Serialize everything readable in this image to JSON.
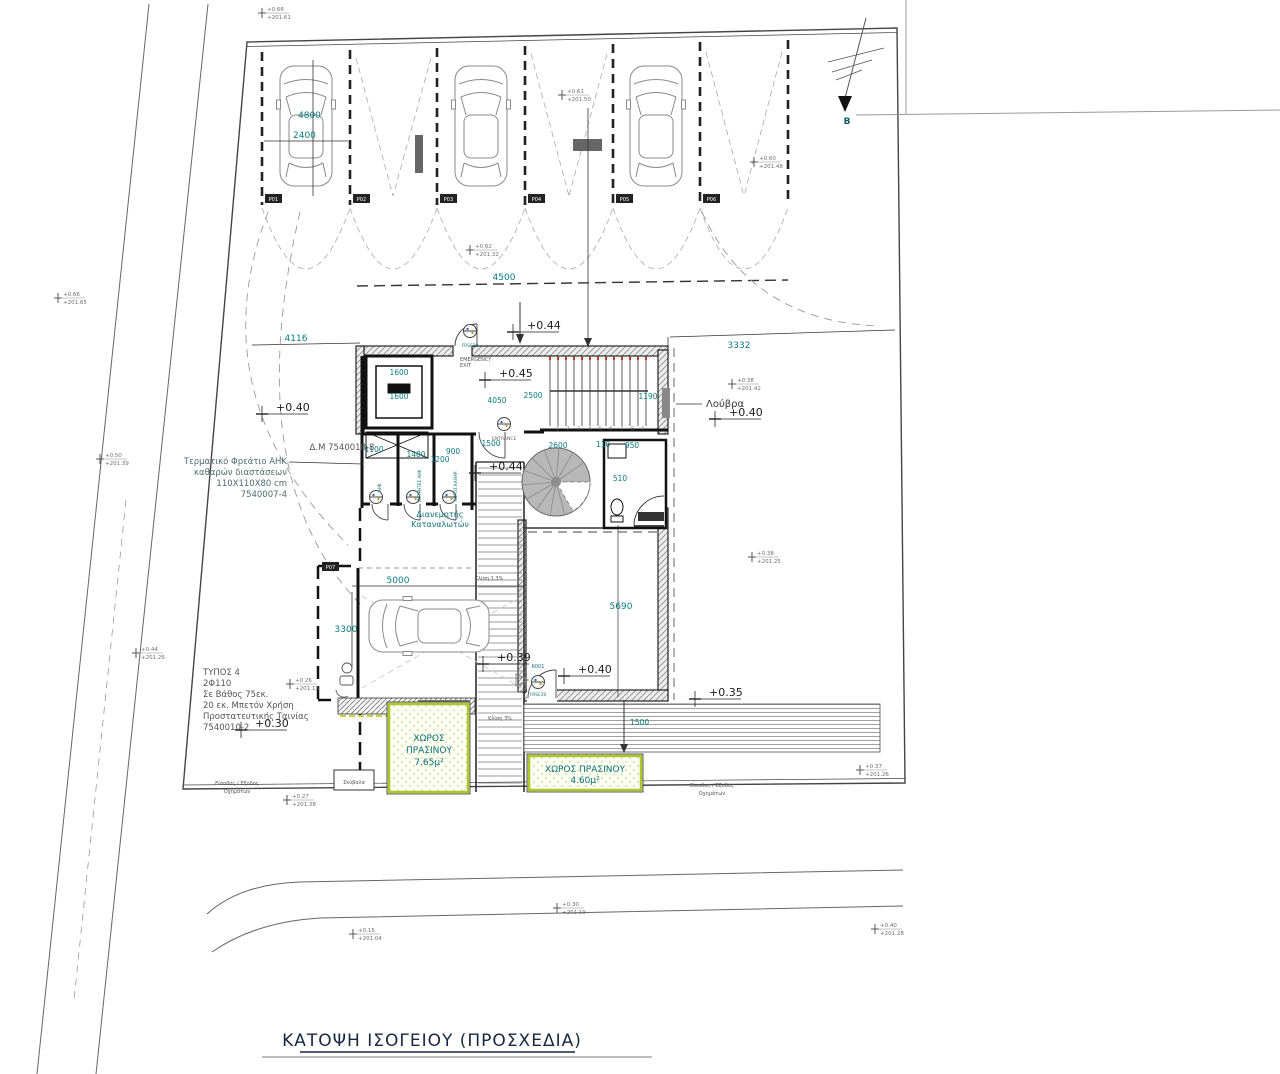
{
  "title": {
    "text": "ΚΑΤΟΨΗ ΙΣΟΓΕΙΟΥ (ΠΡΟΣΧΕΔΙΑ)"
  },
  "north_label": "Β",
  "colors": {
    "accent_teal": "#0b7a80",
    "wall_black": "#111111",
    "green_border": "#aec829",
    "stair_gray": "#b8b8b8",
    "line_gray": "#3c3c3c"
  },
  "parking_tags": [
    {
      "label": "P01",
      "x": 265,
      "y": 194
    },
    {
      "label": "P02",
      "x": 353,
      "y": 194
    },
    {
      "label": "P03",
      "x": 440,
      "y": 194
    },
    {
      "label": "P04",
      "x": 528,
      "y": 194
    },
    {
      "label": "P05",
      "x": 616,
      "y": 194
    },
    {
      "label": "P06",
      "x": 703,
      "y": 194
    },
    {
      "label": "P07",
      "x": 322,
      "y": 562
    }
  ],
  "annotations": [
    {
      "n": "dim-4800",
      "t": "4800",
      "x": 298,
      "y": 118,
      "c": "dim"
    },
    {
      "n": "dim-2400",
      "t": "2400",
      "x": 293,
      "y": 138,
      "c": "dim"
    },
    {
      "n": "dim-4500",
      "t": "4500",
      "x": 504,
      "y": 280,
      "c": "dim",
      "a": "middle"
    },
    {
      "n": "dim-4116",
      "t": "4116",
      "x": 296,
      "y": 341,
      "c": "dim",
      "a": "middle"
    },
    {
      "n": "dim-3332",
      "t": "3332",
      "x": 739,
      "y": 348,
      "c": "dim",
      "a": "middle"
    },
    {
      "n": "dim-1600-a",
      "t": "1600",
      "x": 399,
      "y": 375,
      "c": "dimsm",
      "a": "middle"
    },
    {
      "n": "dim-1600-b",
      "t": "1600",
      "x": 399,
      "y": 399,
      "c": "dimsm",
      "a": "middle"
    },
    {
      "n": "dim-4050",
      "t": "4050",
      "x": 497,
      "y": 403,
      "c": "dimsm",
      "a": "middle"
    },
    {
      "n": "dim-2500",
      "t": "2500",
      "x": 533,
      "y": 398,
      "c": "dimsm",
      "a": "middle"
    },
    {
      "n": "dim-1190",
      "t": "1190",
      "x": 648,
      "y": 399,
      "c": "dimsm",
      "a": "middle"
    },
    {
      "n": "dim-1100",
      "t": "1100",
      "x": 374,
      "y": 452,
      "c": "dimsm",
      "a": "middle"
    },
    {
      "n": "dim-1400",
      "t": "1400",
      "x": 416,
      "y": 457,
      "c": "dimsm",
      "a": "middle"
    },
    {
      "n": "dim-900",
      "t": "900",
      "x": 453,
      "y": 454,
      "c": "dimsm",
      "a": "middle"
    },
    {
      "n": "dim-1200",
      "t": "1200",
      "x": 440,
      "y": 462,
      "c": "dimsm",
      "a": "middle"
    },
    {
      "n": "dim-1500-entry",
      "t": "1500",
      "x": 491,
      "y": 446,
      "c": "dimsm",
      "a": "middle"
    },
    {
      "n": "dim-2600",
      "t": "2600",
      "x": 558,
      "y": 448,
      "c": "dimsm",
      "a": "middle"
    },
    {
      "n": "dim-110",
      "t": "110",
      "x": 603,
      "y": 447,
      "c": "dimsm",
      "a": "middle"
    },
    {
      "n": "dim-950",
      "t": "950",
      "x": 632,
      "y": 448,
      "c": "dimsm",
      "a": "middle"
    },
    {
      "n": "dim-510",
      "t": "510",
      "x": 620,
      "y": 481,
      "c": "dimsm",
      "a": "middle"
    },
    {
      "n": "dim-5000",
      "t": "5000",
      "x": 398,
      "y": 583,
      "c": "dim",
      "a": "middle"
    },
    {
      "n": "dim-3300",
      "t": "3300",
      "x": 346,
      "y": 632,
      "c": "dim",
      "a": "middle"
    },
    {
      "n": "dim-5690",
      "t": "5690",
      "x": 621,
      "y": 609,
      "c": "dim",
      "a": "middle"
    },
    {
      "n": "dim-1500-green",
      "t": "1500",
      "x": 630,
      "y": 725,
      "c": "dimsm",
      "a": "start"
    },
    {
      "n": "label-emergency-exit",
      "t": "EMERGENCY\nEXIT",
      "x": 460,
      "y": 361,
      "c": "micro",
      "lh": 6
    },
    {
      "n": "label-entrance",
      "t": "ENTRANCE",
      "x": 492,
      "y": 440,
      "c": "micro2"
    },
    {
      "n": "label-louvra",
      "t": "Λούβρα",
      "x": 706,
      "y": 407,
      "c": "lbl-dark",
      "a": "start"
    },
    {
      "n": "label-dm-note",
      "t": "Δ.Μ 7540018-8",
      "x": 342,
      "y": 450,
      "c": "note-gray",
      "a": "middle"
    },
    {
      "n": "note-ahk",
      "t": "Τερματικό Φρεάτιο ΑΗΚ\nκαθαρών διαστάσεων\n110Χ110Χ80 cm\n7540007-4",
      "x": 287,
      "y": 464,
      "c": "note",
      "a": "end",
      "lh": 11
    },
    {
      "n": "note-typos",
      "t": "ΤΥΠΟΣ 4\n2Φ110\nΣε Βάθος 75εκ.\n20 εκ. Μπετόν Χρήση\nΠροστατευτικής Ταινίας\n7540010-2",
      "x": 203,
      "y": 675,
      "c": "note-gray",
      "a": "start",
      "lh": 11
    },
    {
      "n": "label-dianemitis",
      "t": "Διανεμητής\nΚαταναλωτών",
      "x": 440,
      "y": 517,
      "c": "lbl-teal",
      "a": "middle",
      "lh": 10
    },
    {
      "n": "label-green-1",
      "t": "ΧΩΡΟΣ\nΠΡΑΣΙΝΟΥ\n7.65μ²",
      "x": 429,
      "y": 741,
      "c": "green-lbl",
      "a": "middle",
      "lh": 12
    },
    {
      "n": "label-green-2",
      "t": "ΧΩΡΟΣ ΠΡΑΣΙΝΟΥ\n4.60μ²",
      "x": 585,
      "y": 772,
      "c": "green-lbl",
      "a": "middle",
      "lh": 11
    },
    {
      "n": "label-skybala",
      "t": "Σκύβαλα",
      "x": 354,
      "y": 784,
      "c": "micro",
      "a": "middle"
    },
    {
      "n": "label-vehicle-entry-left",
      "t": "Είσοδος / Έξοδος\nΟχημάτων",
      "x": 237,
      "y": 785,
      "c": "micro",
      "a": "middle",
      "lh": 8
    },
    {
      "n": "label-vehicle-entry-right",
      "t": "Είσοδος / Έξοδος\nΟχημάτων",
      "x": 712,
      "y": 787,
      "c": "micro",
      "a": "middle",
      "lh": 8
    },
    {
      "n": "label-klisi-13",
      "t": "Κλίση 1.3%",
      "x": 489,
      "y": 580,
      "c": "micro",
      "a": "middle"
    },
    {
      "n": "label-klisi-3",
      "t": "Κλίση 3%",
      "x": 500,
      "y": 720,
      "c": "micro",
      "a": "middle"
    },
    {
      "n": "label-stair-numbers",
      "t": "1 2 3 4 5 6 7 8 9",
      "x": 556,
      "y": 430,
      "c": "micro2",
      "a": "start",
      "ls": 3.2
    },
    {
      "n": "label-room-ahk",
      "t": "ΑΗΚ",
      "x": 381,
      "y": 488,
      "c": "tiny-tag",
      "a": "middle",
      "r": -90
    },
    {
      "n": "label-room-metrites",
      "t": "ΜΕΤΡΗΤΕΣ ΑΗΚ",
      "x": 421,
      "y": 486,
      "c": "tiny-tag",
      "a": "middle",
      "r": -90
    },
    {
      "n": "label-room-katharismou",
      "t": "ΧΩΡΟΣ ΚΑΘΑΡ.",
      "x": 457,
      "y": 486,
      "c": "tiny-tag",
      "a": "middle",
      "r": -90
    },
    {
      "n": "label-door-k001",
      "t": "K001",
      "x": 538,
      "y": 668,
      "c": "k-tag",
      "a": "middle"
    },
    {
      "n": "label-frsc-entry",
      "t": "FRSC30",
      "x": 470,
      "y": 347,
      "c": "tiny-tag",
      "a": "middle"
    },
    {
      "n": "label-frsc-k001",
      "t": "FRSC30",
      "x": 538,
      "y": 696,
      "c": "tiny-tag",
      "a": "middle"
    }
  ],
  "levels": [
    {
      "n": "level-044-top",
      "t": "+0.44",
      "x": 527,
      "y": 329
    },
    {
      "n": "level-045-hall",
      "t": "+0.45",
      "x": 499,
      "y": 377
    },
    {
      "n": "level-044-corridor",
      "t": "+0.44",
      "x": 489,
      "y": 470
    },
    {
      "n": "level-040-right",
      "t": "+0.40",
      "x": 729,
      "y": 416
    },
    {
      "n": "level-040-left",
      "t": "+0.40",
      "x": 276,
      "y": 411
    },
    {
      "n": "level-040-room",
      "t": "+0.40",
      "x": 578,
      "y": 673
    },
    {
      "n": "level-039-garage",
      "t": "+0.39",
      "x": 497,
      "y": 661
    },
    {
      "n": "level-030-yard",
      "t": "+0.30",
      "x": 255,
      "y": 727
    },
    {
      "n": "level-035-ramp",
      "t": "+0.35",
      "x": 709,
      "y": 696
    }
  ],
  "spot_elevations": [
    {
      "n": "spot-1",
      "x": 262,
      "y": 12,
      "v": "+0.66",
      "d": "+201.61"
    },
    {
      "n": "spot-2",
      "x": 58,
      "y": 297,
      "v": "+0.66",
      "d": "+201.65"
    },
    {
      "n": "spot-3",
      "x": 100,
      "y": 458,
      "v": "+0.50",
      "d": "+201.39"
    },
    {
      "n": "spot-4",
      "x": 136,
      "y": 652,
      "v": "+0.44",
      "d": "+201.26"
    },
    {
      "n": "spot-5",
      "x": 562,
      "y": 94,
      "v": "+0.61",
      "d": "+201.50"
    },
    {
      "n": "spot-6",
      "x": 754,
      "y": 161,
      "v": "+0.60",
      "d": "+201.48"
    },
    {
      "n": "spot-7",
      "x": 470,
      "y": 249,
      "v": "+0.62",
      "d": "+201.32"
    },
    {
      "n": "spot-8",
      "x": 732,
      "y": 383,
      "v": "+0.38",
      "d": "+201.42"
    },
    {
      "n": "spot-9",
      "x": 752,
      "y": 556,
      "v": "+0.38",
      "d": "+201.25"
    },
    {
      "n": "spot-10",
      "x": 290,
      "y": 683,
      "v": "+0.26",
      "d": "+201.13"
    },
    {
      "n": "spot-11",
      "x": 287,
      "y": 799,
      "v": "+0.27",
      "d": "+201.38"
    },
    {
      "n": "spot-12",
      "x": 860,
      "y": 769,
      "v": "+0.37",
      "d": "+201.26"
    },
    {
      "n": "spot-13",
      "x": 557,
      "y": 907,
      "v": "+0.30",
      "d": "+201.19"
    },
    {
      "n": "spot-14",
      "x": 353,
      "y": 933,
      "v": "+0.15",
      "d": "+201.04"
    },
    {
      "n": "spot-15",
      "x": 875,
      "y": 928,
      "v": "+0.40",
      "d": "+201.28"
    }
  ]
}
